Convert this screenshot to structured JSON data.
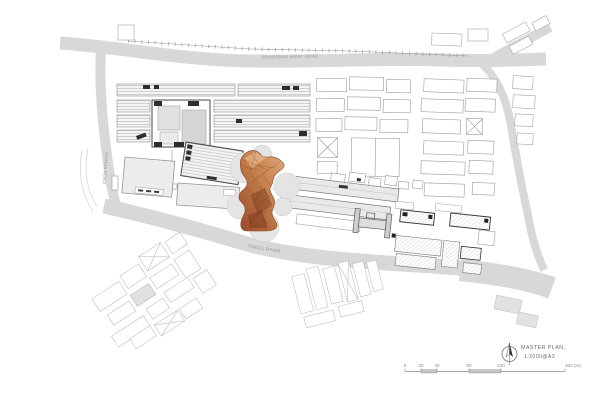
{
  "title_block": {
    "title": "MASTER PLAN,",
    "scale": "1:2000@A3",
    "north_arrow_icon": "north-arrow"
  },
  "road_labels": {
    "top": "DONGFENG WEST ROAD",
    "left": "XINHUA ROAD",
    "river": "TANGZI RIVER"
  },
  "scale_bar": {
    "ticks": [
      "0",
      "20",
      "40",
      "80",
      "120"
    ],
    "end": "200 (m)"
  },
  "colors": {
    "road": "#d8d8d8",
    "highlight_light": "#e2aa79",
    "highlight_dark": "#96482a",
    "outline": "#9b9b9b"
  }
}
